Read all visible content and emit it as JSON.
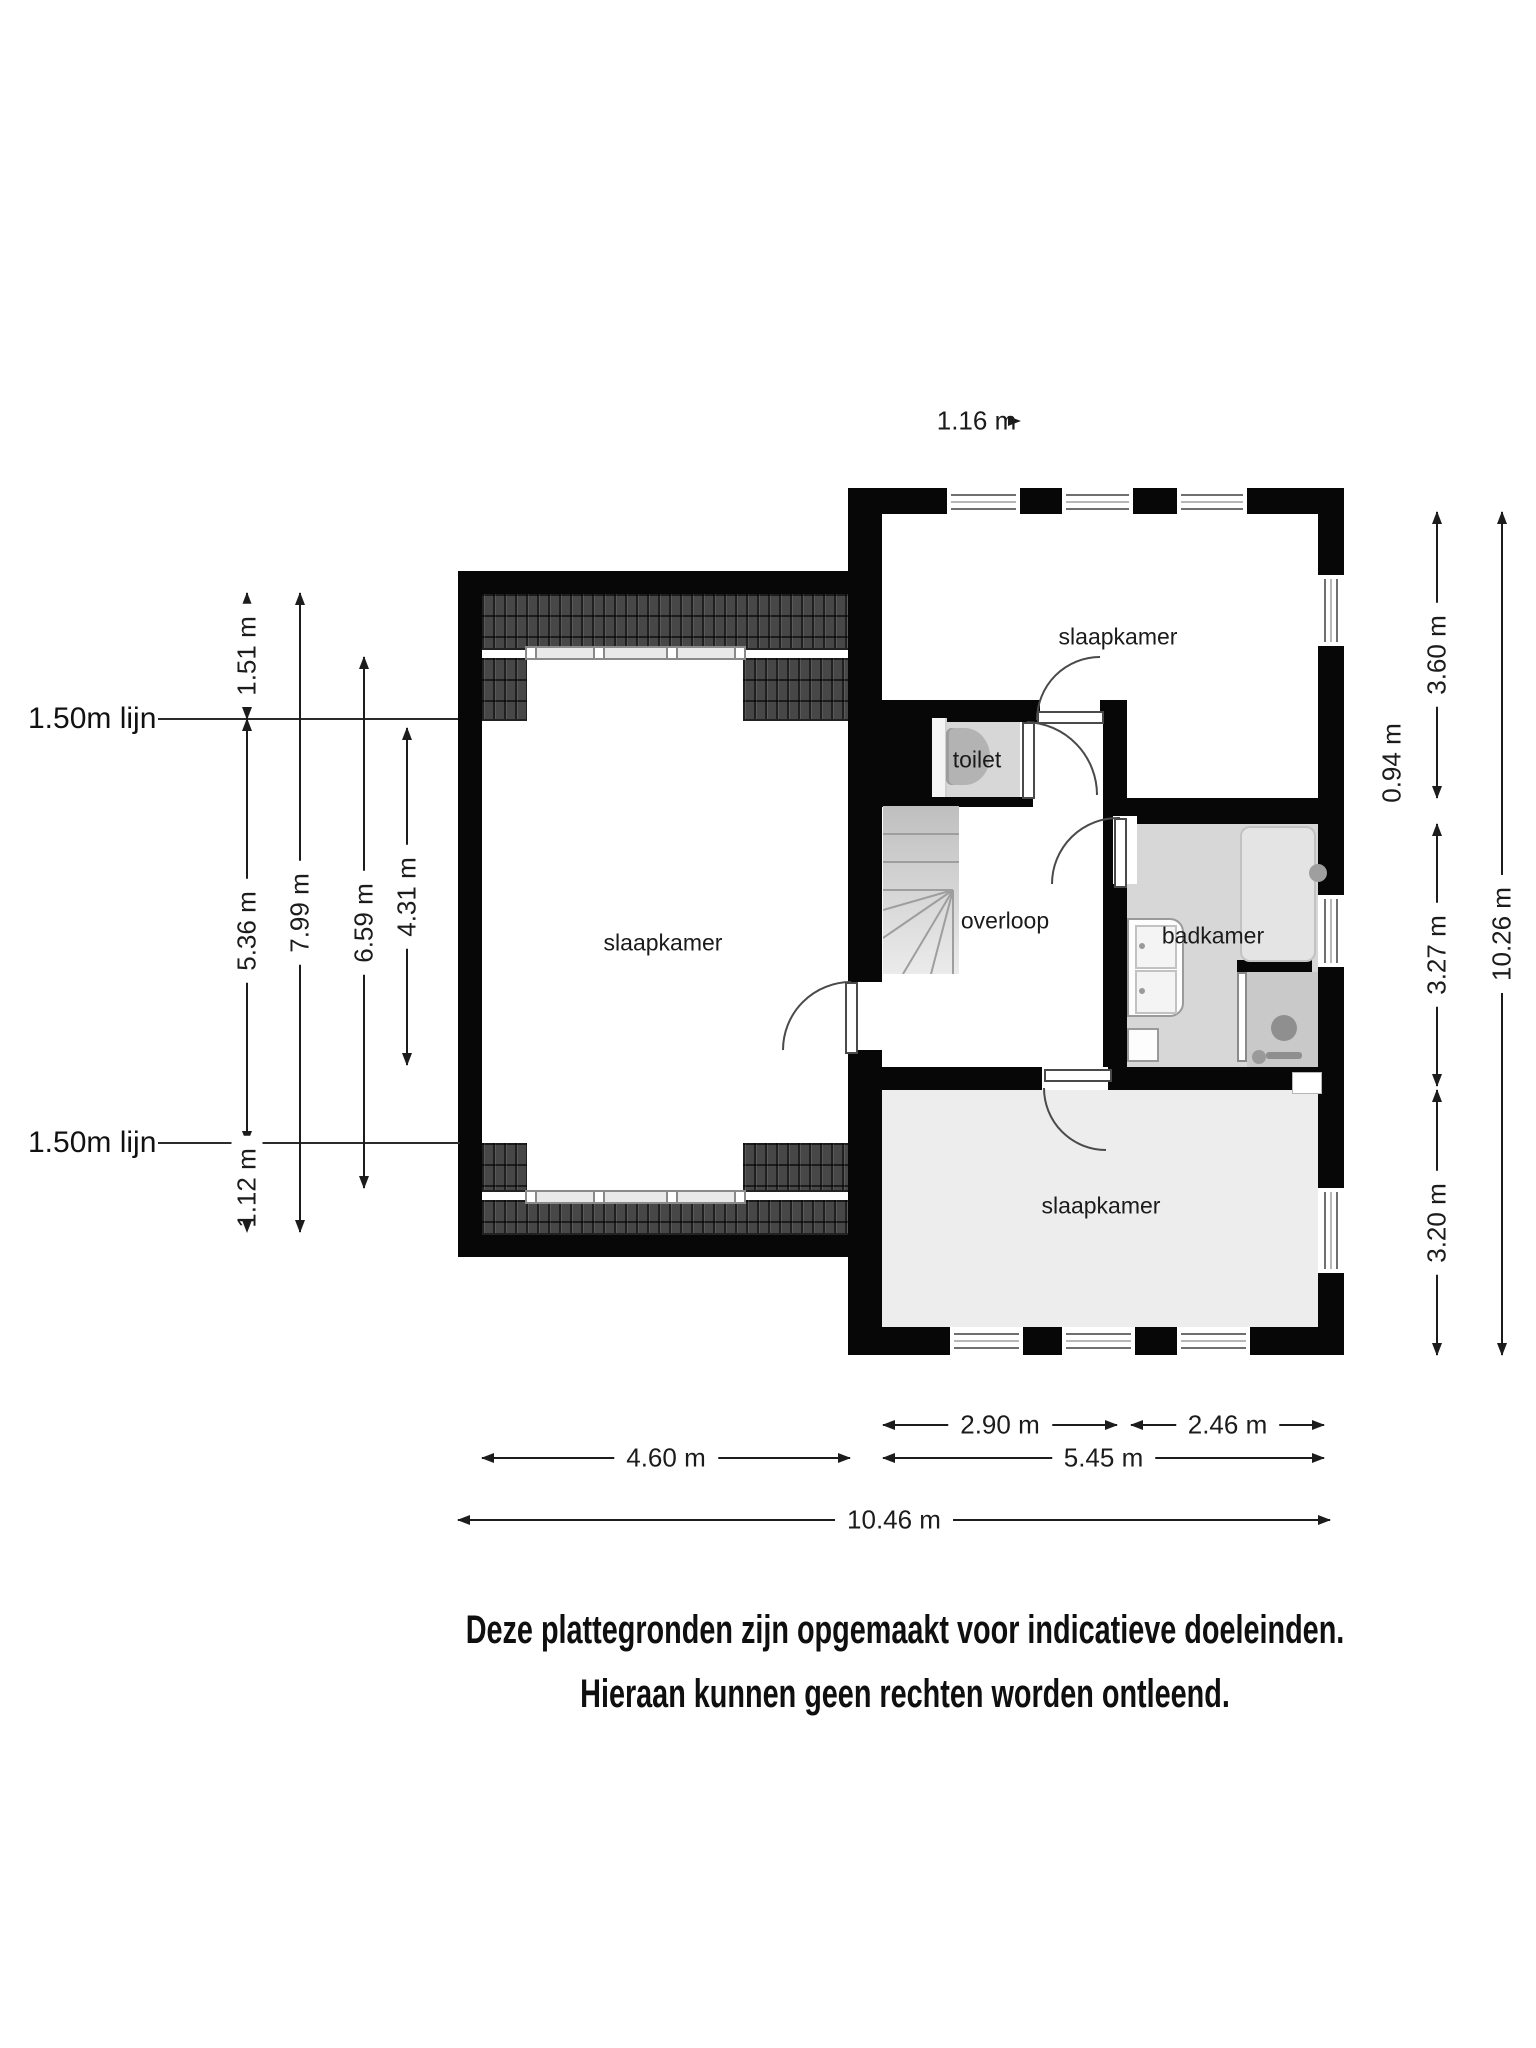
{
  "floorplan": {
    "rooms": [
      {
        "name": "bedroom-left",
        "label": "slaapkamer"
      },
      {
        "name": "bedroom-top",
        "label": "slaapkamer"
      },
      {
        "name": "toilet",
        "label": "toilet"
      },
      {
        "name": "landing",
        "label": "overloop"
      },
      {
        "name": "bathroom",
        "label": "badkamer"
      },
      {
        "name": "bedroom-bottom",
        "label": "slaapkamer"
      }
    ],
    "height_lines": [
      {
        "label": "1.50m lijn"
      },
      {
        "label": "1.50m lijn"
      }
    ],
    "dimensions": {
      "top": [
        {
          "label": "1.16 m"
        }
      ],
      "left": [
        {
          "label": "1.51 m"
        },
        {
          "label": "5.36 m"
        },
        {
          "label": "1.12 m"
        },
        {
          "label": "7.99 m"
        },
        {
          "label": "6.59 m"
        },
        {
          "label": "4.31 m"
        }
      ],
      "right": [
        {
          "label": "3.60 m"
        },
        {
          "label": "0.94 m"
        },
        {
          "label": "3.27 m"
        },
        {
          "label": "3.20 m"
        },
        {
          "label": "10.26 m"
        }
      ],
      "bottom": [
        {
          "label": "2.90 m"
        },
        {
          "label": "2.46 m"
        },
        {
          "label": "4.60 m"
        },
        {
          "label": "5.45 m"
        },
        {
          "label": "10.46 m"
        }
      ]
    },
    "disclaimer": [
      "Deze plattegronden zijn opgemaakt voor indicatieve doeleinden.",
      "Hieraan kunnen geen rechten worden ontleend."
    ],
    "colors": {
      "wall": "#070707",
      "roof_tiles": "#474747",
      "bathroom_floor": "#d7d7d7",
      "bedroom_bottom_floor": "#ededed",
      "shower_floor": "#c9c9c9"
    }
  }
}
